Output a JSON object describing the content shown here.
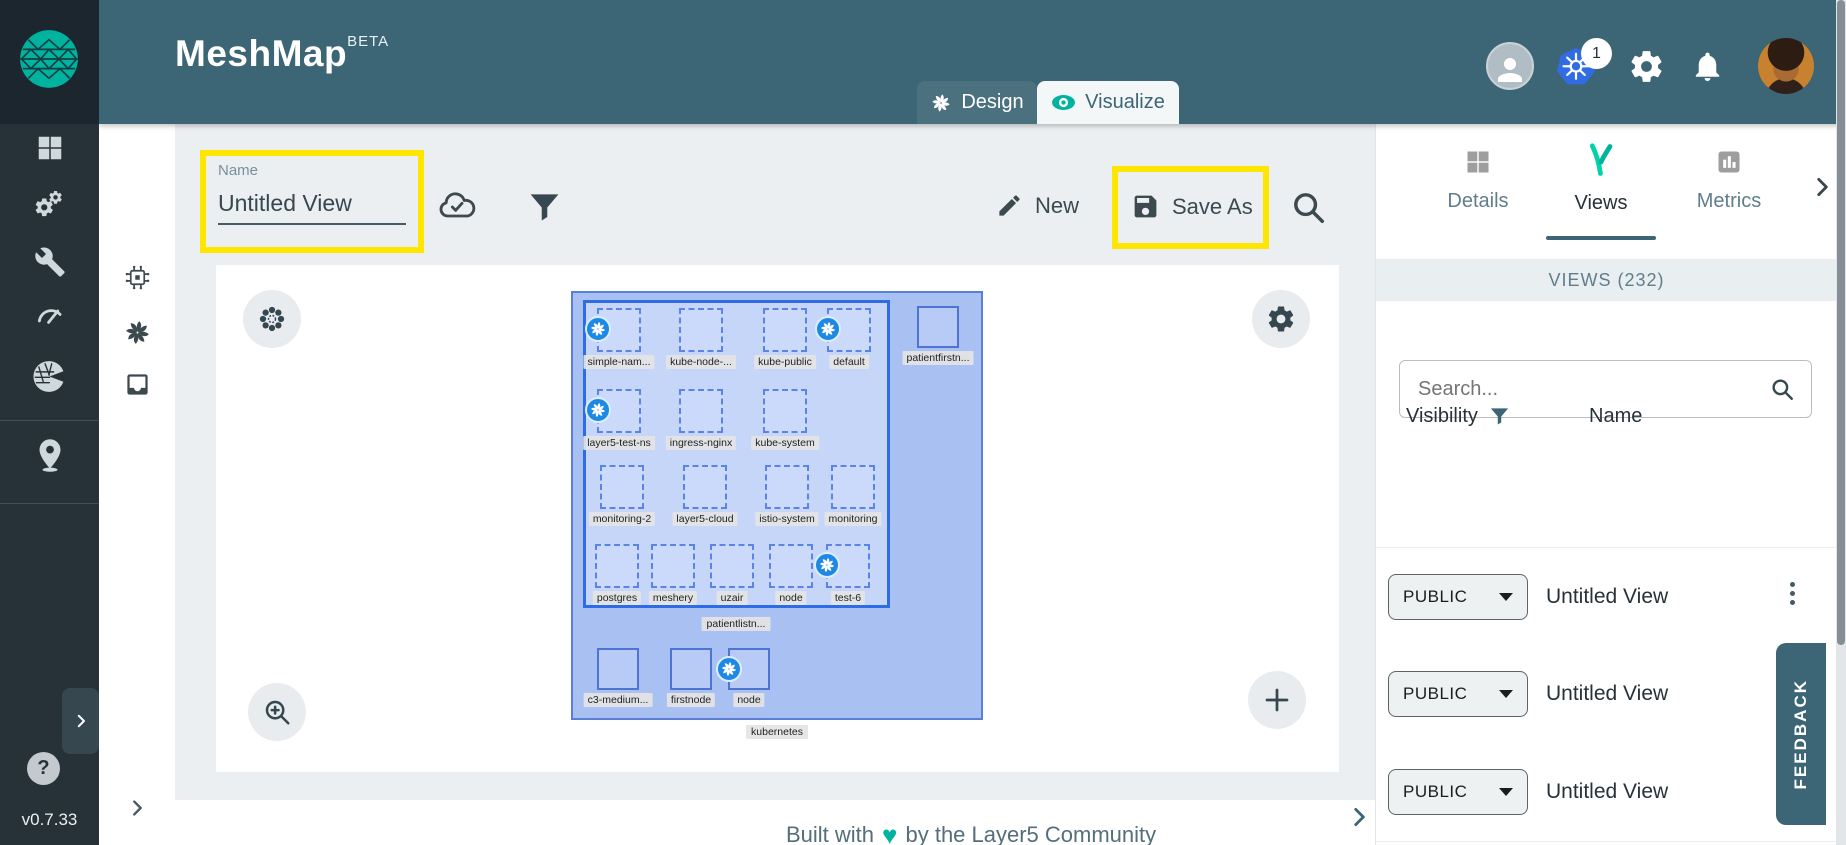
{
  "header": {
    "title": "MeshMap",
    "beta": "BETA",
    "design_tab": "Design",
    "visualize_tab": "Visualize",
    "k8s_badge": "1"
  },
  "sidebar": {
    "version": "v0.7.33",
    "help_label": "?"
  },
  "secondary": {
    "wa_label": "WA"
  },
  "toolbar": {
    "name_label": "Name",
    "name_value": "Untitled View",
    "new_label": "New",
    "save_as_label": "Save As"
  },
  "canvas": {
    "outer_label": "kubernetes",
    "inner_label": "patientlistn...",
    "outside_node": {
      "label": "patientfirstn..."
    },
    "node_rows": [
      [
        {
          "label": "simple-nam...",
          "badge": true
        },
        {
          "label": "kube-node-...",
          "badge": false
        },
        {
          "label": "kube-public",
          "badge": false
        },
        {
          "label": "default",
          "badge": true
        }
      ],
      [
        {
          "label": "layer5-test-ns",
          "badge": true
        },
        {
          "label": "ingress-nginx",
          "badge": false
        },
        {
          "label": "kube-system",
          "badge": false
        }
      ],
      [
        {
          "label": "monitoring-2",
          "badge": false
        },
        {
          "label": "layer5-cloud",
          "badge": false
        },
        {
          "label": "istio-system",
          "badge": false
        },
        {
          "label": "monitoring",
          "badge": false
        }
      ],
      [
        {
          "label": "postgres",
          "badge": false
        },
        {
          "label": "meshery",
          "badge": false
        },
        {
          "label": "uzair",
          "badge": false
        },
        {
          "label": "node",
          "badge": false
        },
        {
          "label": "test-6",
          "badge": true
        }
      ]
    ],
    "bottom_nodes": [
      {
        "label": "c3-medium...",
        "badge": false
      },
      {
        "label": "firstnode",
        "badge": false
      },
      {
        "label": "node",
        "badge": true
      }
    ]
  },
  "right_panel": {
    "tab_details": "Details",
    "tab_views": "Views",
    "tab_metrics": "Metrics",
    "section_title": "VIEWS (232)",
    "search_placeholder": "Search...",
    "col_visibility": "Visibility",
    "col_name": "Name",
    "rows": [
      {
        "visibility": "PUBLIC",
        "name": "Untitled View"
      },
      {
        "visibility": "PUBLIC",
        "name": "Untitled View"
      },
      {
        "visibility": "PUBLIC",
        "name": "Untitled View"
      }
    ],
    "feedback": "FEEDBACK"
  },
  "footer": {
    "prefix": "Built with",
    "heart": "♥",
    "suffix": "by the Layer5 Community"
  },
  "colors": {
    "header_teal": "#3c6575",
    "accent_green": "#00b39f",
    "highlight_yellow": "#ffe600",
    "k8s_blue": "#326ce5",
    "cluster_blue": "#2d6ce2",
    "sidebar_dark": "#263238"
  }
}
